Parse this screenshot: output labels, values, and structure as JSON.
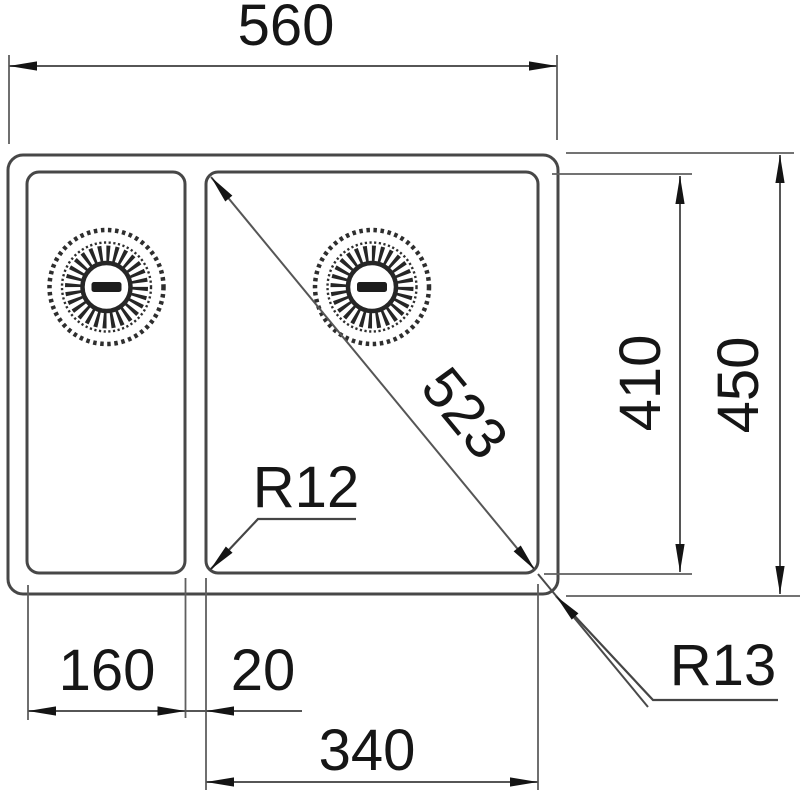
{
  "drawing": {
    "type": "technical-dimension-drawing",
    "subject": "double-bowl-sink-top-view",
    "dimensions": {
      "overall_width": "560",
      "overall_depth": "450",
      "bowl_depth": "410",
      "diagonal": "523",
      "small_bowl_width": "160",
      "bowl_gap": "20",
      "large_bowl_width": "340",
      "inner_corner_radius": "R12",
      "outer_corner_radius": "R13"
    },
    "icons": {
      "left_drain": "basket-strainer-drain-icon",
      "right_drain": "basket-strainer-drain-icon"
    },
    "colors": {
      "outline": "#474747",
      "dimension_line": "#5f5f5f",
      "text": "#161616",
      "background": "#ffffff"
    }
  }
}
